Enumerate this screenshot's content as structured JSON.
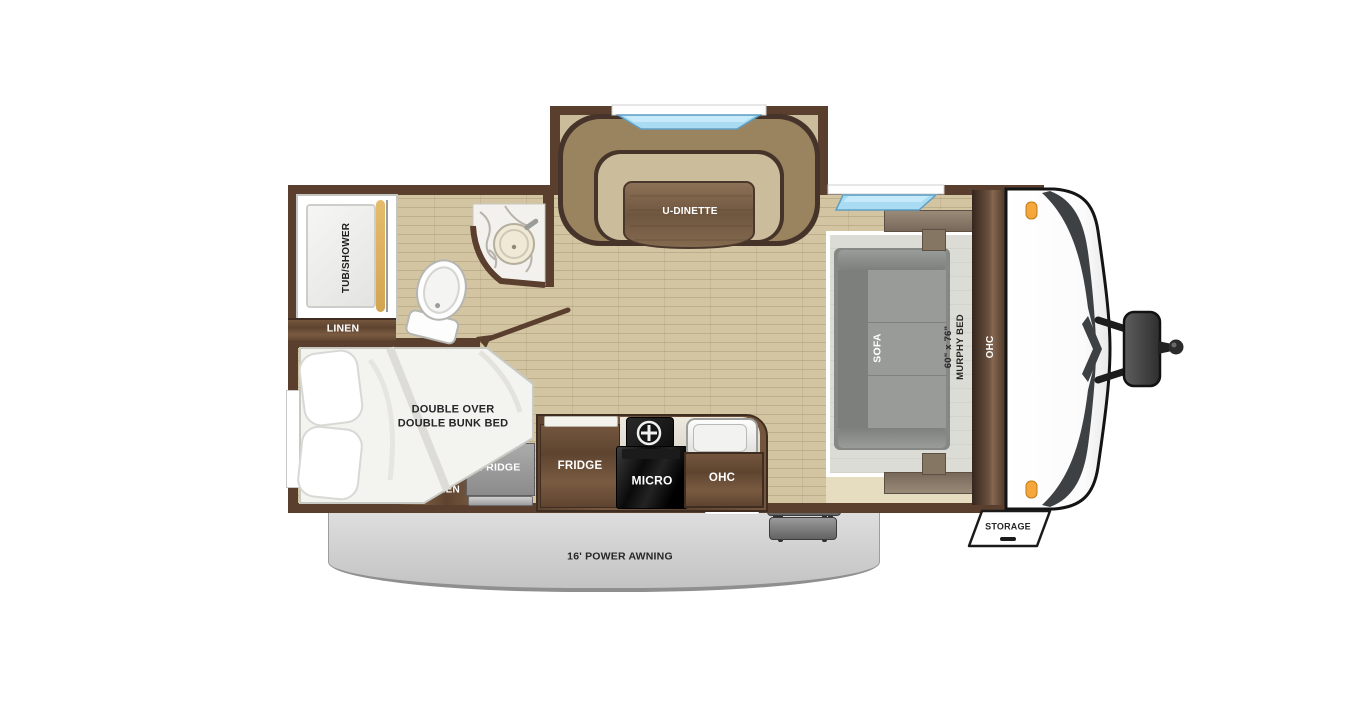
{
  "floorplan": {
    "title": "travel trailer floor plan",
    "labels": {
      "tub_shower": "TUB/SHOWER",
      "linen": "LINEN",
      "u_dinette": "U-DINETTE",
      "sofa": "SOFA",
      "murphy_size": "60\" x 76\"",
      "murphy_bed": "MURPHY BED",
      "ohc_front": "OHC",
      "bunk_line1": "DOUBLE OVER",
      "bunk_line2": "DOUBLE BUNK BED",
      "outside_kitchen_line1": "OUTSIDE",
      "outside_kitchen_line2": "KITCHEN",
      "outside_fridge": "FRIDGE",
      "fridge": "FRIDGE",
      "micro": "MICRO",
      "ohc_kitchen": "OHC",
      "storage": "STORAGE",
      "awning": "16' POWER AWNING"
    },
    "colors": {
      "wall": "#5a3e2e",
      "floor": "#d3c5a2",
      "slidefloor": "#cbbc9b",
      "bench": "#9a845f",
      "bench_edge": "#46342a",
      "table_wood": "#7a5f45",
      "sofa_gray": "#8f918f",
      "murphy_panel": "#dcdcd6",
      "awning_gray": "#cccccc",
      "window_blue": "#9fd4ec",
      "marker_orange": "#f5a73b",
      "cap_white": "#ffffff",
      "hitch_gray": "#3a3a3a"
    }
  }
}
